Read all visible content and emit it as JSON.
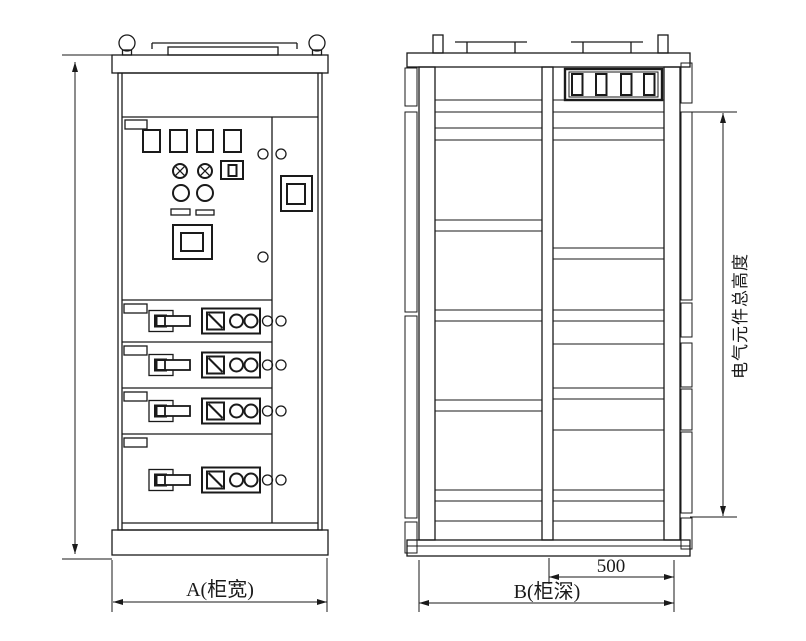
{
  "title": "switchgear-cabinet-outline-drawing",
  "colors": {
    "line": "#1a1a1a",
    "background": "#ffffff"
  },
  "labels": {
    "width": "A(柜宽)",
    "depth": "B(柜深)",
    "depth_partial": "500",
    "component_height": "电气元件总高度"
  },
  "views": {
    "front": {
      "lifting_eyes": 2,
      "indicator_windows": 4,
      "signal_lamps": 2,
      "pushbuttons": 2,
      "meters": 1,
      "door_handles": 1,
      "feeder_rows": 4
    },
    "side": {
      "lifting_eyes": 2,
      "vent_slots": 4
    }
  }
}
